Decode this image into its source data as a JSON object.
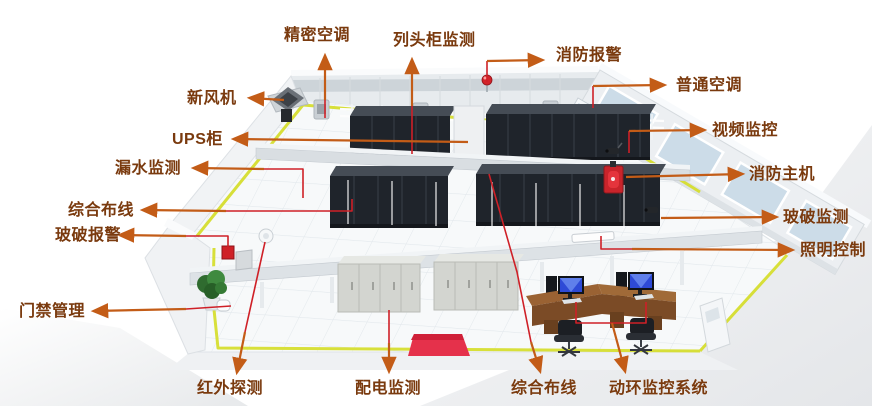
{
  "diagram_type": "datacenter-monitoring-system-illustration",
  "annotations": [
    {
      "id": "fresh-air-unit",
      "text": "新风机"
    },
    {
      "id": "precision-ac",
      "text": "精密空调"
    },
    {
      "id": "row-head-cabinet-monitoring",
      "text": "列头柜监测"
    },
    {
      "id": "fire-alarm",
      "text": "消防报警"
    },
    {
      "id": "normal-ac",
      "text": "普通空调"
    },
    {
      "id": "ups-cabinet",
      "text": "UPS柜"
    },
    {
      "id": "video-surveillance",
      "text": "视频监控"
    },
    {
      "id": "water-leak-monitoring",
      "text": "漏水监测"
    },
    {
      "id": "fire-host",
      "text": "消防主机"
    },
    {
      "id": "integrated-cabling-left",
      "text": "综合布线"
    },
    {
      "id": "glass-break-monitoring",
      "text": "玻破监测"
    },
    {
      "id": "glass-break-alarm",
      "text": "玻破报警"
    },
    {
      "id": "lighting-control",
      "text": "照明控制"
    },
    {
      "id": "access-control",
      "text": "门禁管理"
    },
    {
      "id": "infrared-detection",
      "text": "红外探测"
    },
    {
      "id": "power-distribution-monitoring",
      "text": "配电监测"
    },
    {
      "id": "integrated-cabling-bottom",
      "text": "综合布线"
    },
    {
      "id": "power-env-monitoring-system",
      "text": "动环监控系统"
    }
  ],
  "colors": {
    "label_text": "#7a3a0e",
    "arrow_orange": "#c35c17",
    "leader_red": "#cf2027",
    "cable_tray_yellow": "#d6de2f",
    "carpet_red": "#e5314b",
    "rack_dark": "#20242b",
    "desk_brown": "#9a6233",
    "wall_light": "#eef1f4",
    "window_blue": "#ccdce8"
  },
  "equipment_icons": [
    "fresh-air-fan-icon",
    "wall-ac-unit-icon",
    "fire-alarm-ball-icon",
    "tall-ac-cabinet-icon",
    "cctv-camera-icon",
    "fire-extinguisher-icon",
    "server-rack-icon",
    "cable-tray-icon",
    "glass-break-sensor-icon",
    "ceiling-light-icon",
    "alarm-box-icon",
    "door-reader-icon",
    "infrared-dome-icon",
    "power-cabinet-icon",
    "red-carpet-icon",
    "operator-desk-icon",
    "monitor-icon",
    "office-chair-icon",
    "plant-icon",
    "standing-ac-icon"
  ]
}
